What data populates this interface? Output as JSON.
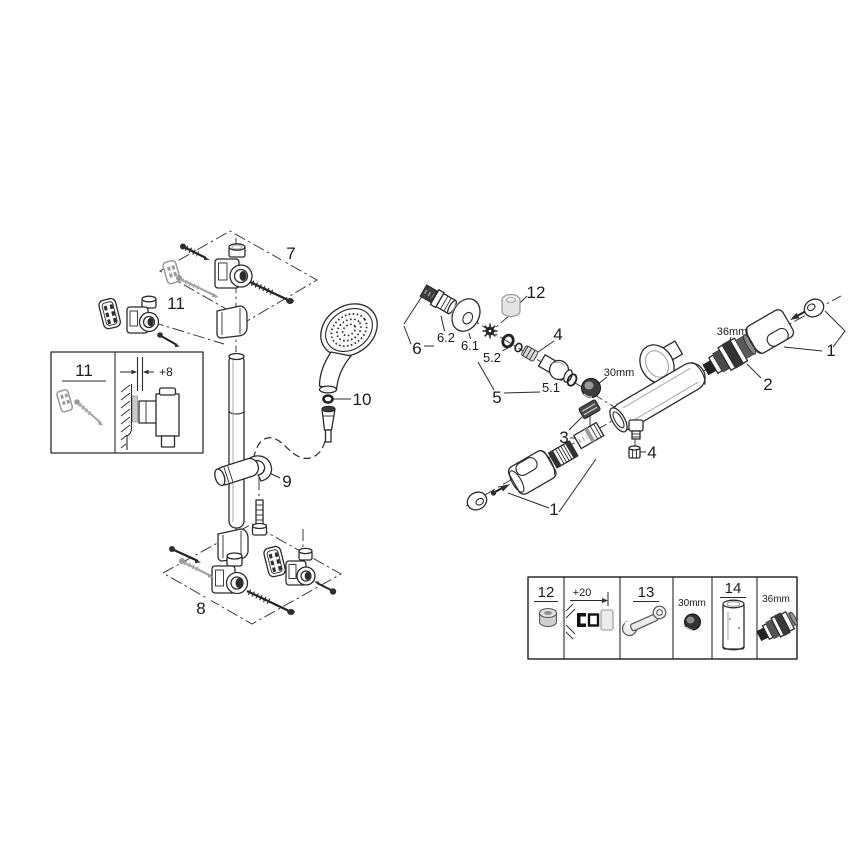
{
  "left_assembly": {
    "part7_label": "7",
    "part11_label": "11",
    "part10_label": "10",
    "part9_label": "9",
    "part8_label": "8",
    "inset": {
      "part11_label": "11",
      "offset_dimension": "+8"
    }
  },
  "right_assembly": {
    "part6_label": "6",
    "part6_2_label": "6.2",
    "part6_1_label": "6.1",
    "part12_label": "12",
    "part4_top_label": "4",
    "part5_2_label": "5.2",
    "part5_label": "5",
    "part5_1_label": "5.1",
    "nut_size_label": "30mm",
    "part3_label": "3",
    "part4_bottom_label": "4",
    "cartridge_size_label": "36mm",
    "part2_label": "2",
    "part1_right_label": "1",
    "part1_bottom_label": "1"
  },
  "legend": {
    "cells": [
      {
        "label": "12",
        "icon": "plug-cap-icon"
      },
      {
        "label": "+20",
        "icon": "extension-depth-diagram-icon"
      },
      {
        "label": "13",
        "icon": "wrench-icon"
      },
      {
        "label": "30mm",
        "icon": "nut-icon"
      },
      {
        "label": "14",
        "icon": "extension-sleeve-icon"
      },
      {
        "label": "36mm",
        "icon": "thermostat-cartridge-icon"
      }
    ]
  },
  "colors": {
    "line": "#2b2b2b",
    "gray_part": "#9a9a9a",
    "dark_fill": "#2e2e2e",
    "background": "#ffffff"
  }
}
